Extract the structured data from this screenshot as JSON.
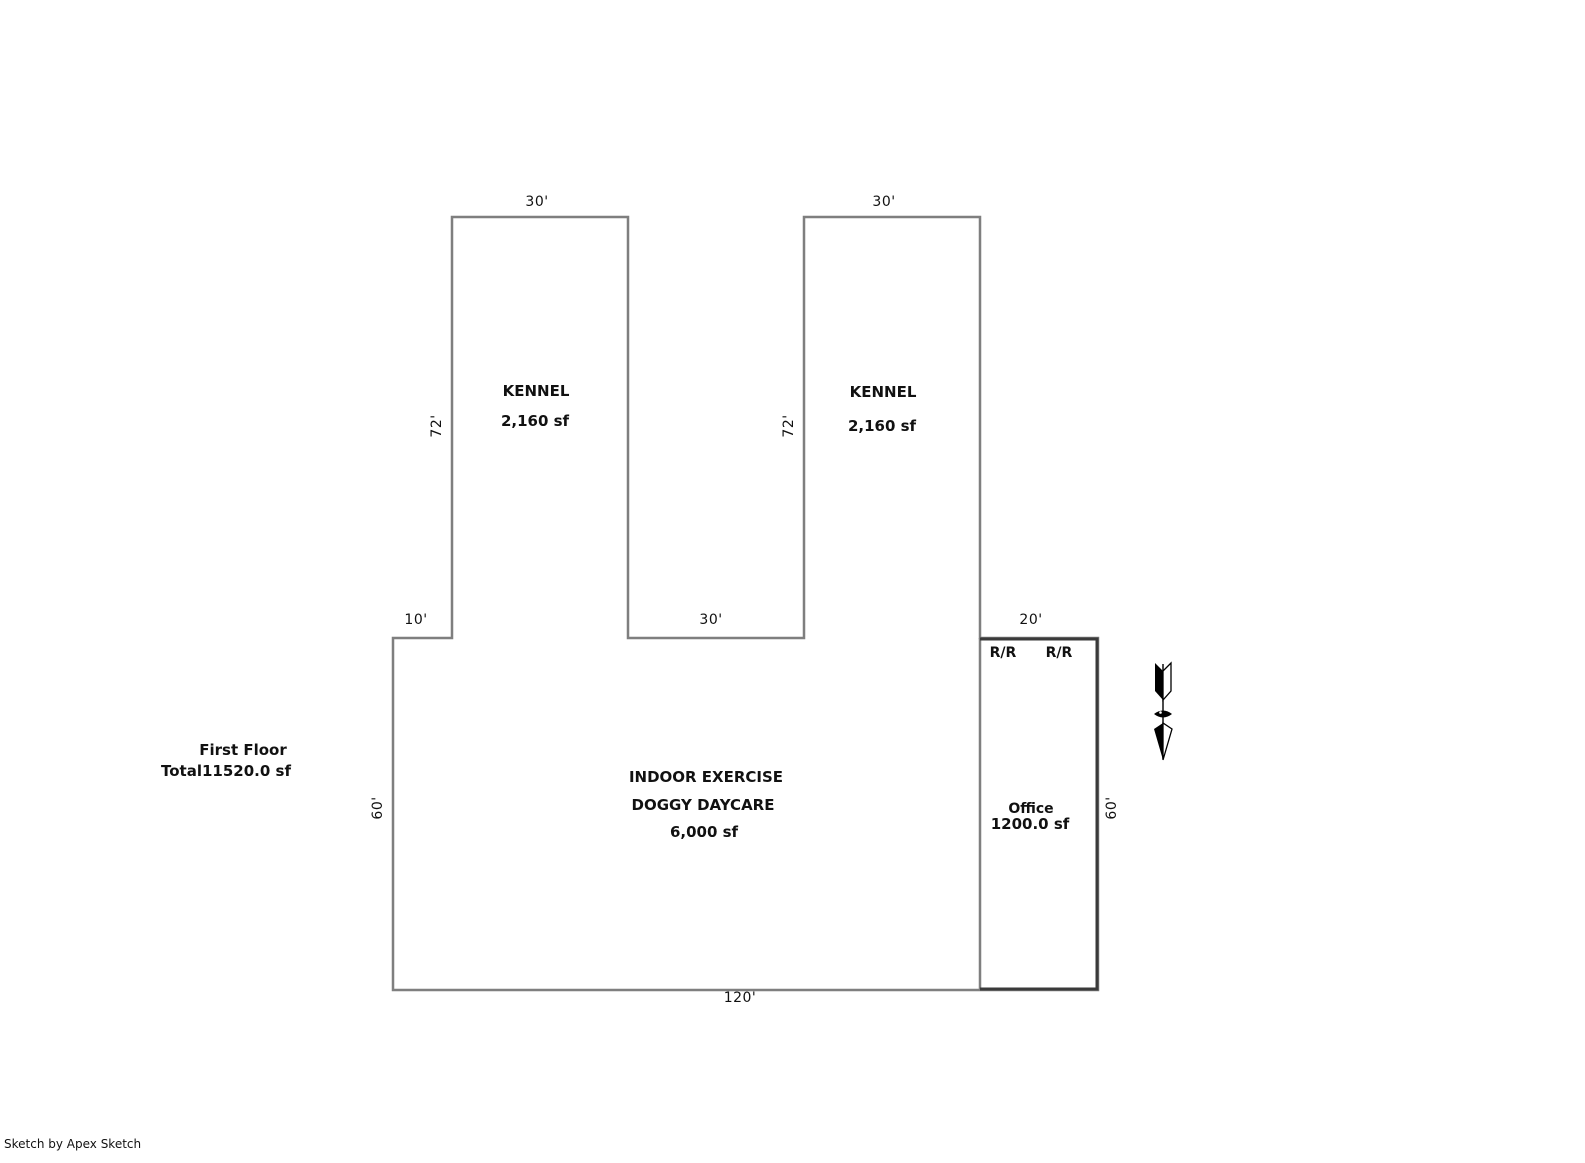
{
  "summary": {
    "line1": "First Floor",
    "line2": "Total11520.0 sf"
  },
  "rooms": {
    "kennel_left": {
      "name": "KENNEL",
      "area": "2,160 sf"
    },
    "kennel_right": {
      "name": "KENNEL",
      "area": "2,160 sf"
    },
    "exercise": {
      "line1": "INDOOR EXERCISE",
      "line2": "DOGGY DAYCARE",
      "area": "6,000 sf"
    },
    "office": {
      "name": "Office",
      "area": "1200.0 sf"
    },
    "restrooms": {
      "left": "R/R",
      "right": "R/R"
    }
  },
  "dimensions": {
    "kennel_left_width": "30'",
    "kennel_right_width": "30'",
    "kennel_left_height": "72'",
    "kennel_right_height": "72'",
    "left_offset": "10'",
    "center_gap": "30'",
    "office_width": "20'",
    "west_height": "60'",
    "east_height": "60'",
    "south_width": "120'"
  },
  "footer": {
    "credit": "Sketch by Apex Sketch"
  },
  "colors": {
    "outline": "#7f7f7f",
    "partition": "#3a3a3a",
    "text": "#111111"
  }
}
